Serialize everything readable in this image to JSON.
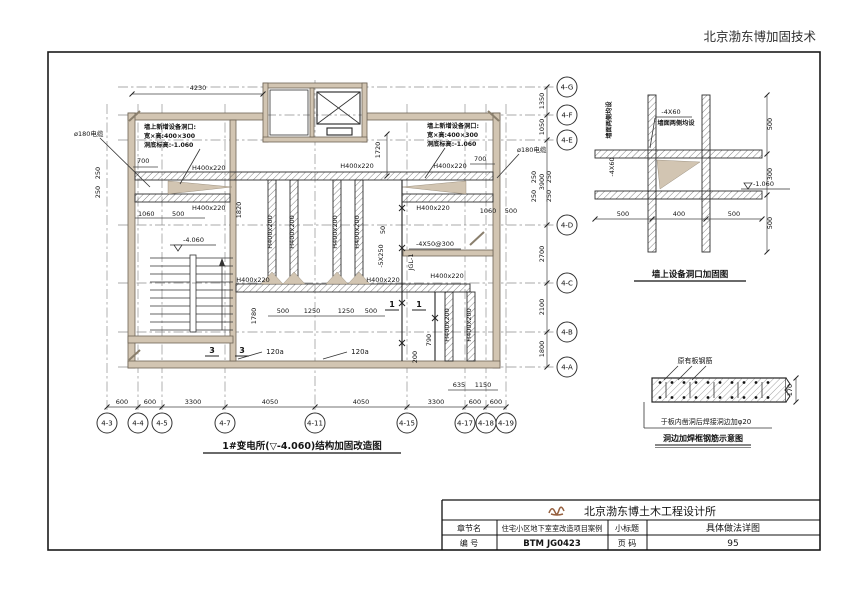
{
  "colors": {
    "wall_fill": "#d2c5b2",
    "line": "#1a1a1a",
    "grid": "#8f8f8f",
    "logo": "#96603f",
    "paper": "#ffffff"
  },
  "sheet": {
    "brand": "北京渤东博加固技术"
  },
  "plan": {
    "title": "1#变电所(▽-4.060)结构加固改造图",
    "opening_note": [
      "墙上新增设备洞口:",
      "宽×高:400×300",
      "洞底标高:-1.060"
    ],
    "cable_label": "ø180电缆",
    "elev_label": "-4.060",
    "beam220": "H400x220",
    "beam200": "H400x200",
    "jgl_label": "JGL-1",
    "plate_note": "-4X50@300",
    "plate_note2": "-5X250",
    "dim_50": "50",
    "trench_label": "120a",
    "section_1": "1",
    "section_3": "3",
    "dims": {
      "d4230": "4230",
      "d700": "700",
      "d250": "250",
      "d1060": "1060",
      "d500": "500",
      "d1820": "1820",
      "d1780": "1780",
      "d1250": "1250",
      "d1720": "1720",
      "d790": "790",
      "d200": "200",
      "d635": "635",
      "d1150": "1150"
    },
    "bottom_dims": [
      "600",
      "600",
      "3300",
      "4050",
      "4050",
      "3300",
      "600",
      "600"
    ],
    "bottom_axes": [
      "4-3",
      "4-4",
      "4-5",
      "4-7",
      "4-11",
      "4-15",
      "4-17",
      "4-18",
      "4-19"
    ],
    "right_dims": [
      "1350",
      "1050",
      "3900",
      "2700",
      "2100",
      "1800"
    ],
    "right_axes": [
      "4-G",
      "4-F",
      "4-E",
      "4-D",
      "4-C",
      "4-B",
      "4-A"
    ]
  },
  "wall_detail": {
    "title": "墙上设备洞口加固图",
    "plate_label": "-4X60",
    "side_note": "墙面两侧均设",
    "elev_label": "-1.060",
    "dims_right": [
      "500",
      "300",
      "500"
    ],
    "dims_bottom": [
      "500",
      "400",
      "500"
    ]
  },
  "slab_detail": {
    "rebar_label": "原有板钢筋",
    "thickness_dim": "170",
    "note": "于板内凿洞后焊接洞边加φ20",
    "title": "洞边加焊框钢筋示意图"
  },
  "title_block": {
    "office": "北京渤东博土木工程设计所",
    "chapter_key": "章节名",
    "chapter_value": "住宅小区地下室室改造项目案例",
    "subtitle_key": "小标题",
    "subtitle_value": "具体做法详图",
    "number_key": "编  号",
    "number_value": "BTM JG0423",
    "page_key": "页  码",
    "page_value": "95"
  }
}
